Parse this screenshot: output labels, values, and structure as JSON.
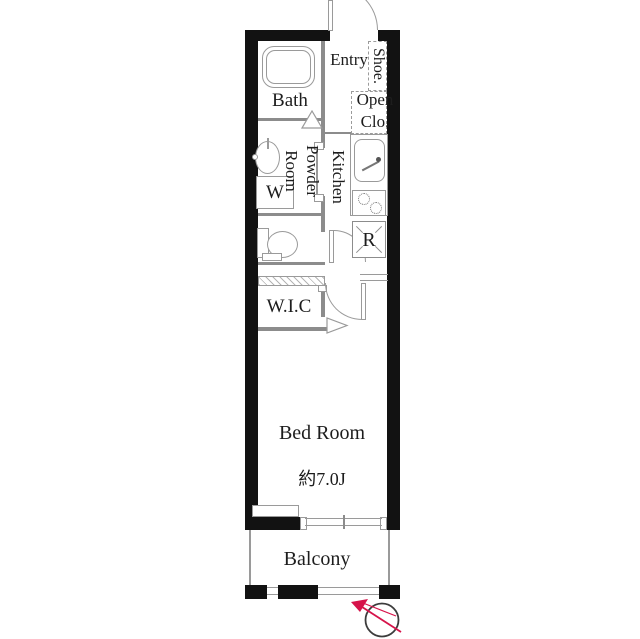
{
  "floorplan": {
    "unit_labels": {
      "entry": "Entry",
      "shoe_closet": "Shoe.",
      "open_closet": "Open Clo.",
      "bath": "Bath",
      "powder_room": "Powder Room",
      "kitchen": "Kitchen",
      "washer_space": "W",
      "refrigerator_space": "R",
      "walk_in_closet": "W.I.C",
      "bedroom": "Bed Room",
      "bedroom_size": "約7.0J",
      "balcony": "Balcony"
    },
    "colors": {
      "wall": "#121212",
      "thin_line": "#8c8c8c",
      "text": "#1d1d1d",
      "compass_red": "#d6134a",
      "compass_ring": "#3c3c3c",
      "background": "#ffffff"
    }
  }
}
